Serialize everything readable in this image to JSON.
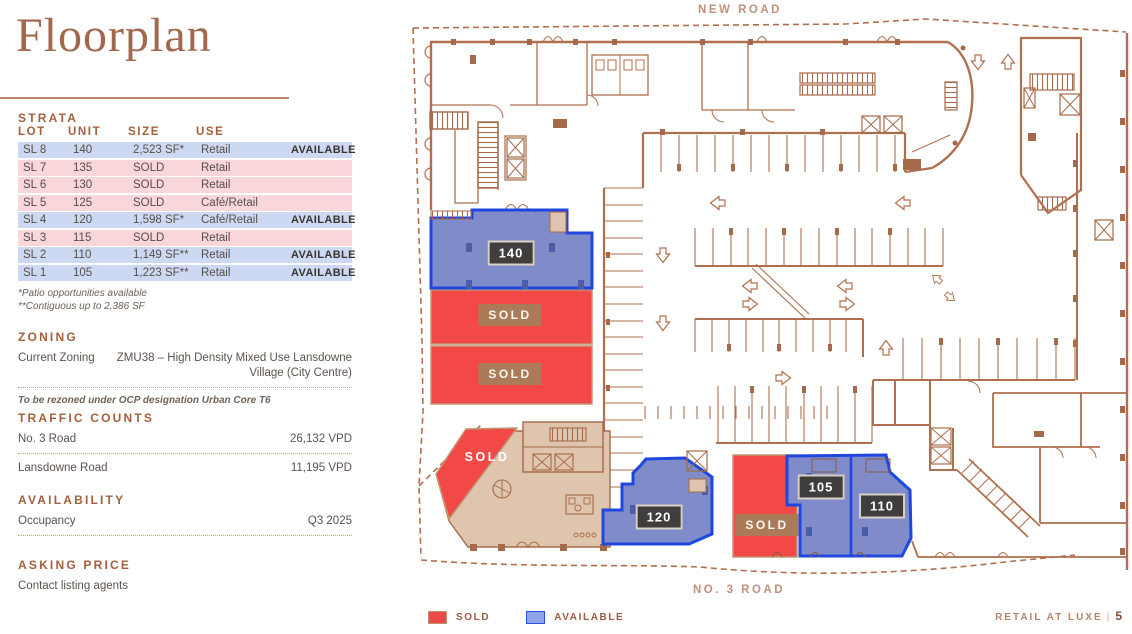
{
  "page": {
    "title": "Floorplan",
    "footer": {
      "brand": "RETAIL AT LUXE",
      "separator": "|",
      "page_number": "5"
    }
  },
  "strata": {
    "heading": "STRATA",
    "columns": {
      "lot": "LOT",
      "unit": "UNIT",
      "size": "SIZE",
      "use": "USE"
    },
    "rows": [
      {
        "lot": "SL 8",
        "unit": "140",
        "size": "2,523 SF*",
        "use": "Retail",
        "tag": "AVAILABLE",
        "status": "available"
      },
      {
        "lot": "SL 7",
        "unit": "135",
        "size": "SOLD",
        "use": "Retail",
        "tag": "",
        "status": "sold"
      },
      {
        "lot": "SL 6",
        "unit": "130",
        "size": "SOLD",
        "use": "Retail",
        "tag": "",
        "status": "sold"
      },
      {
        "lot": "SL 5",
        "unit": "125",
        "size": "SOLD",
        "use": "Café/Retail",
        "tag": "",
        "status": "sold"
      },
      {
        "lot": "SL 4",
        "unit": "120",
        "size": "1,598 SF*",
        "use": "Café/Retail",
        "tag": "AVAILABLE",
        "status": "available"
      },
      {
        "lot": "SL 3",
        "unit": "115",
        "size": "SOLD",
        "use": "Retail",
        "tag": "",
        "status": "sold"
      },
      {
        "lot": "SL 2",
        "unit": "110",
        "size": "1,149 SF**",
        "use": "Retail",
        "tag": "AVAILABLE",
        "status": "available"
      },
      {
        "lot": "SL 1",
        "unit": "105",
        "size": "1,223 SF**",
        "use": "Retail",
        "tag": "AVAILABLE",
        "status": "available"
      }
    ],
    "footnotes": [
      "*Patio opportunities available",
      "**Contiguous up to 2,386 SF"
    ]
  },
  "zoning": {
    "heading": "ZONING",
    "label": "Current Zoning",
    "value_line1": "ZMU38 – High Density Mixed Use Lansdowne",
    "value_line2": "Village (City Centre)",
    "note": "To be rezoned under OCP designation Urban Core T6"
  },
  "traffic_counts": {
    "heading": "TRAFFIC COUNTS",
    "rows": [
      {
        "label": "No. 3 Road",
        "value": "26,132 VPD"
      },
      {
        "label": "Lansdowne Road",
        "value": "11,195 VPD"
      }
    ]
  },
  "availability": {
    "heading": "AVAILABILITY",
    "label": "Occupancy",
    "value": "Q3 2025"
  },
  "asking_price": {
    "heading": "ASKING PRICE",
    "value": "Contact listing agents"
  },
  "floorplan": {
    "roads": {
      "top": "NEW ROAD",
      "bottom": "NO. 3 ROAD"
    },
    "units": [
      {
        "unit": "140",
        "label": "140",
        "status": "available"
      },
      {
        "unit": "135",
        "label": "SOLD",
        "status": "sold"
      },
      {
        "unit": "130",
        "label": "SOLD",
        "status": "sold"
      },
      {
        "unit": "125",
        "label": "SOLD",
        "status": "sold"
      },
      {
        "unit": "120",
        "label": "120",
        "status": "available"
      },
      {
        "unit": "115",
        "label": "SOLD",
        "status": "sold"
      },
      {
        "unit": "105",
        "label": "105",
        "status": "available"
      },
      {
        "unit": "110",
        "label": "110",
        "status": "available"
      }
    ],
    "legend": [
      {
        "label": "SOLD",
        "color": "#ee4a45"
      },
      {
        "label": "AVAILABLE",
        "color": "#8fa3e8"
      }
    ],
    "colors": {
      "sold_fill": "#f24846",
      "available_fill": "#7f8cc9",
      "available_border": "#1f47df",
      "line": "#b06f4f"
    }
  }
}
